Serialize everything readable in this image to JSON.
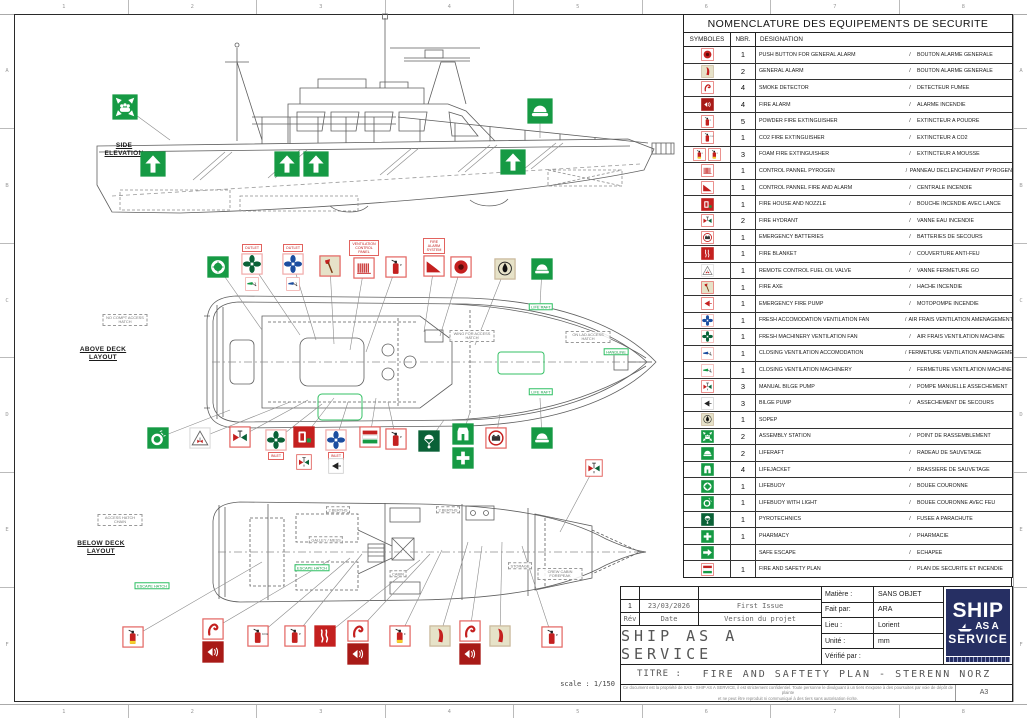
{
  "frame": {
    "cols": [
      "1",
      "2",
      "3",
      "4",
      "5",
      "6",
      "7",
      "8"
    ],
    "rows_letters": [
      "A",
      "B",
      "C",
      "D",
      "E",
      "F"
    ]
  },
  "colors": {
    "red": "#c4201f",
    "dark_red": "#a81a17",
    "green": "#169a44",
    "dark_green": "#0a6137",
    "blue": "#1c4da0",
    "beige": "#e6e2c8",
    "red_border": "#e2635f",
    "navy": "#262f63"
  },
  "table": {
    "title": "NOMENCLATURE DES EQUIPEMENTS DE SECURITE",
    "headers": {
      "symbols": "SYMBOLES",
      "qty": "NBR.",
      "designation": "DESIGNATION"
    },
    "separator": "/",
    "rows": [
      {
        "icons": [
          "push-button"
        ],
        "qty": "1",
        "en": "PUSH BUTTON FOR GENERAL ALARM",
        "fr": "BOUTON ALARME GENERALE"
      },
      {
        "icons": [
          "general-alarm"
        ],
        "qty": "2",
        "en": "GENERAL ALARM",
        "fr": "BOUTON ALARME GENERALE"
      },
      {
        "icons": [
          "smoke-detector"
        ],
        "qty": "4",
        "en": "SMOKE DETECTOR",
        "fr": "DETECTEUR FUMEE"
      },
      {
        "icons": [
          "fire-alarm"
        ],
        "qty": "4",
        "en": "FIRE ALARM",
        "fr": "ALARME INCENDIE"
      },
      {
        "icons": [
          "ext-powder"
        ],
        "qty": "5",
        "en": "POWDER FIRE EXTINGUISHER",
        "fr": "EXTINCTEUR A POUDRE"
      },
      {
        "icons": [
          "ext-co2"
        ],
        "qty": "1",
        "en": "CO2 FIRE EXTINGUISHER",
        "fr": "EXTINCTEUR A CO2"
      },
      {
        "icons": [
          "ext-foam",
          "ext-foam"
        ],
        "qty": "3",
        "en": "FOAM FIRE EXTINGUISHER",
        "fr": "EXTINCTEUR A MOUSSE"
      },
      {
        "icons": [
          "panel-pyrogen"
        ],
        "qty": "1",
        "en": "CONTROL PANNEL PYROGEN",
        "fr": "PANNEAU DECLENCHEMENT PYROGEN"
      },
      {
        "icons": [
          "panel-fire-alarm"
        ],
        "qty": "1",
        "en": "CONTROL PANNEL FIRE AND ALARM",
        "fr": "CENTRALE INCENDIE"
      },
      {
        "icons": [
          "fire-house-nozzle"
        ],
        "qty": "1",
        "en": "FIRE HOUSE AND NOZZLE",
        "fr": "BOUCHE INCENDIE AVEC LANCE"
      },
      {
        "icons": [
          "fire-hydrant"
        ],
        "qty": "2",
        "en": "FIRE HYDRANT",
        "fr": "VANNE EAU INCENDIE"
      },
      {
        "icons": [
          "emergency-batteries"
        ],
        "qty": "1",
        "en": "EMERGENCY BATTERIES",
        "fr": "BATTERIES DE SECOURS"
      },
      {
        "icons": [
          "fire-blanket"
        ],
        "qty": "1",
        "en": "FIRE BLANKET",
        "fr": "COUVERTURE ANTI-FEU"
      },
      {
        "icons": [
          "remote-fuel-valve"
        ],
        "qty": "1",
        "en": "REMOTE CONTROL FUEL OIL VALVE",
        "fr": "VANNE FERMETURE GO"
      },
      {
        "icons": [
          "fire-axe"
        ],
        "qty": "1",
        "en": "FIRE AXE",
        "fr": "HACHE INCENDIE"
      },
      {
        "icons": [
          "emergency-fire-pump"
        ],
        "qty": "1",
        "en": "EMERGENCY FIRE PUMP",
        "fr": "MOTOPOMPE INCENDIE"
      },
      {
        "icons": [
          "fan-blue"
        ],
        "qty": "1",
        "en": "FRESH ACCOMODATION VENTILATION FAN",
        "fr": "AIR FRAIS VENTILATION AMENAGEMENT"
      },
      {
        "icons": [
          "fan-green"
        ],
        "qty": "1",
        "en": "FRESH MACHINERY VENTILATION FAN",
        "fr": "AIR FRAIS VENTILATION MACHINE"
      },
      {
        "icons": [
          "closing-vent-blue"
        ],
        "qty": "1",
        "en": "CLOSING VENTILATION ACCOMODATION",
        "fr": "FERMETURE VENTILATION AMENAGEMENT"
      },
      {
        "icons": [
          "closing-vent-green"
        ],
        "qty": "1",
        "en": "CLOSING VENTILATION MACHINERY",
        "fr": "FERMETURE VENTILATION MACHINE"
      },
      {
        "icons": [
          "manual-bilge-pump"
        ],
        "qty": "3",
        "en": "MANUAL BILGE PUMP",
        "fr": "POMPE MANUELLE ASSECHEMENT"
      },
      {
        "icons": [
          "bilge-pump"
        ],
        "qty": "3",
        "en": "BILGE PUMP",
        "fr": "ASSECHEMENT DE SECOURS"
      },
      {
        "icons": [
          "sopep"
        ],
        "qty": "1",
        "en": "SOPEP",
        "fr": ""
      },
      {
        "icons": [
          "assembly-station"
        ],
        "qty": "2",
        "en": "ASSEMBLY STATION",
        "fr": "POINT DE RASSEMBLEMENT"
      },
      {
        "icons": [
          "liferaft"
        ],
        "qty": "2",
        "en": "LIFERAFT",
        "fr": "RADEAU DE SAUVETAGE"
      },
      {
        "icons": [
          "lifejacket"
        ],
        "qty": "4",
        "en": "LIFEJACKET",
        "fr": "BRASSIERE DE SAUVETAGE"
      },
      {
        "icons": [
          "lifebuoy"
        ],
        "qty": "1",
        "en": "LIFEBUOY",
        "fr": "BOUEE COURONNE"
      },
      {
        "icons": [
          "lifebuoy-light"
        ],
        "qty": "1",
        "en": "LIFEBUOY WITH LIGHT",
        "fr": "BOUEE COURONNE AVEC FEU"
      },
      {
        "icons": [
          "pyrotechnics"
        ],
        "qty": "1",
        "en": "PYROTECHNICS",
        "fr": "FUSEE A PARACHUTE"
      },
      {
        "icons": [
          "pharmacy"
        ],
        "qty": "1",
        "en": "PHARMACY",
        "fr": "PHARMACIE"
      },
      {
        "icons": [
          "safe-escape"
        ],
        "qty": "",
        "en": "SAFE ESCAPE",
        "fr": "ECHAPEE"
      },
      {
        "icons": [
          "safety-plan"
        ],
        "qty": "1",
        "en": "FIRE AND SAFETY PLAN",
        "fr": "PLAN DE SECURITE ET INCENDIE"
      }
    ]
  },
  "views": {
    "scale_note": "scale : 1/150",
    "side": {
      "label1": "SIDE",
      "label2": "ELEVATION",
      "markers": [
        {
          "t": "assembly-station",
          "x": 125,
          "y": 107,
          "s": 26,
          "lead": [
            170,
            140
          ]
        },
        {
          "t": "liferaft",
          "x": 540,
          "y": 111,
          "s": 26,
          "lead": [
            540,
            138
          ]
        },
        {
          "t": "arrow-up",
          "x": 153,
          "y": 164,
          "s": 26
        },
        {
          "t": "arrow-up",
          "x": 287,
          "y": 164,
          "s": 26
        },
        {
          "t": "arrow-up",
          "x": 316,
          "y": 164,
          "s": 26
        },
        {
          "t": "arrow-up",
          "x": 513,
          "y": 162,
          "s": 26
        }
      ]
    },
    "above": {
      "label1": "ABOVE DECK",
      "label2": "LAYOUT",
      "markers": [
        {
          "t": "lifebuoy",
          "x": 218,
          "y": 267,
          "lead": [
            262,
            330
          ]
        },
        {
          "t": "fan-green",
          "x": 252,
          "y": 264,
          "lbl": "OUTLET",
          "lead": [
            300,
            335
          ]
        },
        {
          "t": "closing-vent-green",
          "x": 252,
          "y": 284,
          "s": 14
        },
        {
          "t": "fan-blue",
          "x": 293,
          "y": 264,
          "lbl": "OUTLET",
          "lead": [
            316,
            340
          ]
        },
        {
          "t": "closing-vent-blue",
          "x": 293,
          "y": 284,
          "s": 14
        },
        {
          "t": "fire-axe",
          "x": 330,
          "y": 266,
          "lead": [
            334,
            344
          ]
        },
        {
          "t": "panel-pyrogen",
          "x": 364,
          "y": 268,
          "lbl": "VENTILATION CONTROL PANEL",
          "lead": [
            350,
            350
          ]
        },
        {
          "t": "ext-powder",
          "x": 396,
          "y": 267,
          "lead": [
            366,
            352
          ]
        },
        {
          "t": "panel-fire-alarm",
          "x": 434,
          "y": 266,
          "lbl": "FIRE ALARM SYSTEM",
          "lead": [
            424,
            332
          ]
        },
        {
          "t": "push-button",
          "x": 461,
          "y": 267,
          "lead": [
            440,
            336
          ]
        },
        {
          "t": "sopep",
          "x": 505,
          "y": 269,
          "lead": [
            475,
            345
          ]
        },
        {
          "t": "liferaft",
          "x": 542,
          "y": 269,
          "lead": [
            540,
            305
          ]
        },
        {
          "t": "lifebuoy-light",
          "x": 158,
          "y": 438,
          "lead": [
            230,
            410
          ]
        },
        {
          "t": "remote-fuel-valve",
          "x": 200,
          "y": 438,
          "lead": [
            290,
            402
          ]
        },
        {
          "t": "fire-hydrant",
          "x": 240,
          "y": 437,
          "lead": [
            308,
            400
          ]
        },
        {
          "t": "fan-green",
          "x": 276,
          "y": 440,
          "lbl": "INLET",
          "lp": "below",
          "lead": [
            322,
            404
          ]
        },
        {
          "t": "fire-house-nozzle",
          "x": 304,
          "y": 437,
          "lead": [
            334,
            398
          ]
        },
        {
          "t": "manual-bilge-pump",
          "x": 304,
          "y": 462,
          "s": 16
        },
        {
          "t": "fan-blue",
          "x": 336,
          "y": 440,
          "lbl": "INLET",
          "lp": "below",
          "lead": [
            348,
            402
          ]
        },
        {
          "t": "bilge-pump",
          "x": 336,
          "y": 466,
          "s": 16
        },
        {
          "t": "safety-plan",
          "x": 370,
          "y": 437,
          "lead": [
            376,
            398
          ]
        },
        {
          "t": "ext-powder",
          "x": 396,
          "y": 439,
          "lead": [
            388,
            402
          ]
        },
        {
          "t": "pyrotechnics",
          "x": 429,
          "y": 441,
          "lead": [
            444,
            420
          ]
        },
        {
          "t": "lifejacket",
          "x": 463,
          "y": 434,
          "lead": [
            470,
            412
          ]
        },
        {
          "t": "pharmacy",
          "x": 463,
          "y": 458
        },
        {
          "t": "emergency-batteries",
          "x": 496,
          "y": 438,
          "lead": [
            500,
            414
          ]
        },
        {
          "t": "liferaft",
          "x": 542,
          "y": 438,
          "lead": [
            540,
            398
          ]
        }
      ],
      "tags": [
        {
          "text": "NO COMPT ACCESS HATCH",
          "x": 125,
          "y": 320,
          "style": "gray"
        },
        {
          "text": "WING FOR ACCESS HATCH",
          "x": 472,
          "y": 336,
          "style": "gray"
        },
        {
          "text": "ON LAD ACCESS HATCH",
          "x": 588,
          "y": 337,
          "style": "gray"
        },
        {
          "text": "HANDLINE",
          "x": 616,
          "y": 352,
          "style": "green"
        },
        {
          "text": "LIFE RAFT",
          "x": 541,
          "y": 307,
          "style": "green"
        },
        {
          "text": "LIFE RAFT",
          "x": 541,
          "y": 392,
          "style": "green"
        }
      ]
    },
    "below": {
      "label1": "BELOW DECK",
      "label2": "LAYOUT",
      "markers": [
        {
          "t": "manual-bilge-pump",
          "x": 594,
          "y": 468,
          "s": 18,
          "lead": [
            560,
            532
          ]
        },
        {
          "t": "ext-foam",
          "x": 133,
          "y": 637,
          "lead": [
            262,
            562
          ]
        },
        {
          "t": "smoke-detector",
          "x": 213,
          "y": 629,
          "lead": [
            330,
            560
          ]
        },
        {
          "t": "fire-alarm",
          "x": 213,
          "y": 652
        },
        {
          "t": "ext-co2",
          "x": 258,
          "y": 636,
          "lead": [
            350,
            558
          ]
        },
        {
          "t": "ext-powder",
          "x": 295,
          "y": 636,
          "lead": [
            362,
            554
          ]
        },
        {
          "t": "fire-blanket",
          "x": 325,
          "y": 636,
          "lead": [
            420,
            560
          ]
        },
        {
          "t": "smoke-detector",
          "x": 358,
          "y": 631,
          "lead": [
            430,
            554
          ]
        },
        {
          "t": "fire-alarm",
          "x": 358,
          "y": 654
        },
        {
          "t": "ext-foam",
          "x": 400,
          "y": 636,
          "lead": [
            442,
            550
          ]
        },
        {
          "t": "general-alarm",
          "x": 440,
          "y": 636,
          "lead": [
            468,
            542
          ]
        },
        {
          "t": "smoke-detector",
          "x": 470,
          "y": 631,
          "lead": [
            482,
            546
          ]
        },
        {
          "t": "fire-alarm",
          "x": 470,
          "y": 654
        },
        {
          "t": "general-alarm",
          "x": 500,
          "y": 636,
          "lead": [
            502,
            542
          ]
        },
        {
          "t": "ext-powder",
          "x": 552,
          "y": 637,
          "lead": [
            522,
            546
          ]
        }
      ],
      "tags": [
        {
          "text": "ACCESS HATCH CHAIN",
          "x": 120,
          "y": 520,
          "style": "gray"
        },
        {
          "text": "ESCAPE HATCH",
          "x": 152,
          "y": 586,
          "style": "green"
        },
        {
          "text": "ESCAPE HATCH",
          "x": 312,
          "y": 568,
          "style": "green"
        },
        {
          "text": "2 BERTHS",
          "x": 338,
          "y": 510,
          "style": "gray"
        },
        {
          "text": "2 BERTHS",
          "x": 448,
          "y": 510,
          "style": "gray"
        },
        {
          "text": "GALLEY / MESS",
          "x": 326,
          "y": 540,
          "style": "gray"
        },
        {
          "text": "CABIN",
          "x": 398,
          "y": 574,
          "style": "gray"
        },
        {
          "text": "STORAGE",
          "x": 520,
          "y": 566,
          "style": "gray"
        },
        {
          "text": "CREW CABIN FOREPEAK",
          "x": 560,
          "y": 574,
          "style": "gray"
        }
      ]
    }
  },
  "title_block": {
    "rev_values": {
      "rev": "1",
      "date": "23/03/2026",
      "desc": "First Issue"
    },
    "rev_headers": {
      "rev": "Rév",
      "date": "Date",
      "desc": "Version du projet"
    },
    "company": "SHIP AS A SERVICE",
    "fields": [
      {
        "label": "Matière :",
        "value": "SANS OBJET"
      },
      {
        "label": "Fait par:",
        "value": "ARA"
      },
      {
        "label": "Lieu :",
        "value": "Lorient"
      },
      {
        "label": "Unité :",
        "value": "mm"
      },
      {
        "label": "Vérifié par :",
        "value": "",
        "nosplit": true
      }
    ],
    "title_label": "TITRE :",
    "title": "FIRE AND SAFTETY PLAN - STERENN NORZ",
    "disclaimer_line1": "Ce document est la propriété de SAS - SHIP AS A SERVICE, il est strictement confidentiel. Toute personne le divulguant à un tiers s'expose à des poursuites par voie de dépôt de plainte",
    "disclaimer_line2": "et ne peut être reproduit ni communiqué à des tiers sans autorisation écrite.",
    "sheet_size": "A3",
    "logo": {
      "line1": "SHIP",
      "line2": "AS A",
      "line3": "SERVICE"
    }
  }
}
